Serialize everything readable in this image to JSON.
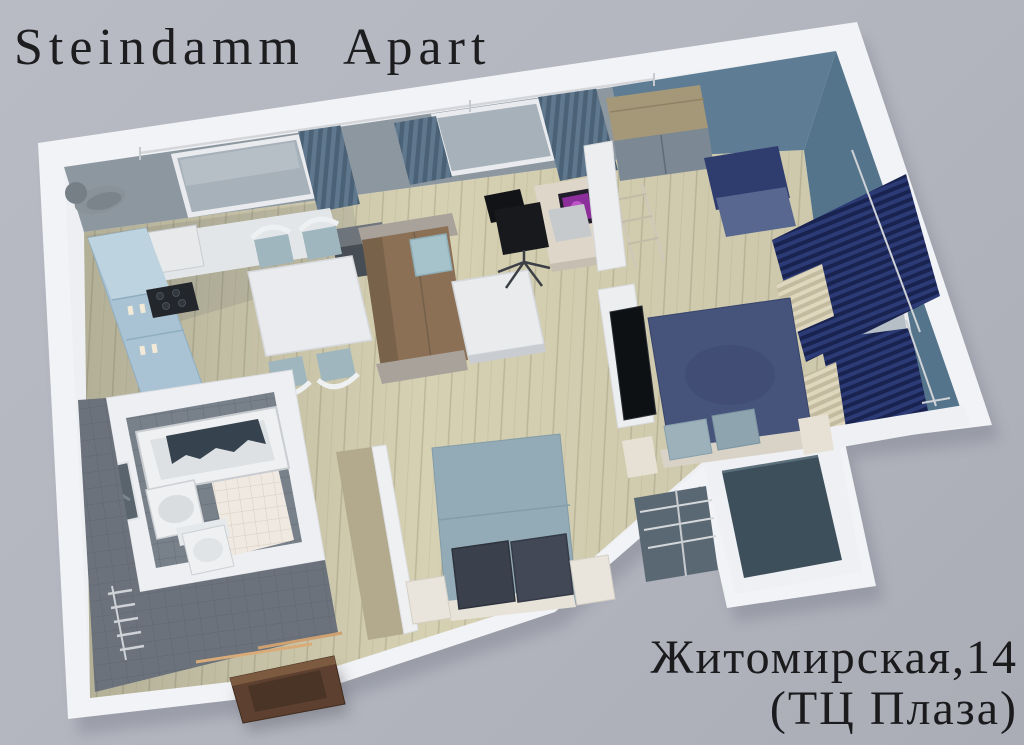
{
  "scene": {
    "kind": "3d-apartment-floorplan-render",
    "title": "Steindamm Apart",
    "address_line1": "Житомирская,14",
    "address_line2": "(ТЦ Плаза)"
  },
  "palette": {
    "background": "#b2b4be",
    "outer_wall_white": "#f2f3f6",
    "inner_wall_gray": "#8d97a0",
    "bedroom_wall_blue": "#5e7d95",
    "floor_wood": "#d7d1b3",
    "floor_tile_dark": "#6b727c",
    "floor_balcony": "#3e4f5c",
    "curtain_navy": "#24306b",
    "curtain_slate": "#5d7489",
    "sofa_brown": "#8b7056",
    "bed_navy": "#46537b",
    "bed_light_blue": "#93abb6",
    "kitchen_cabinet_blue": "#a9c3d4",
    "entrance_door_brown": "#5d4030",
    "text": "#1d1d20"
  },
  "rooms": [
    "kitchen",
    "dining-area",
    "living-room",
    "bedroom",
    "second-bedroom",
    "bathroom",
    "hallway",
    "balcony"
  ],
  "furniture": [
    "kitchen-cabinets",
    "fridge",
    "stove",
    "dining-table",
    "dining-chairs",
    "sofa",
    "sofa-pillow",
    "coffee-table",
    "desk",
    "laptop",
    "office-chair",
    "shelf-ladder",
    "wardrobe",
    "armchair",
    "navy-double-bed",
    "tv",
    "radiators",
    "window-curtains",
    "light-blue-double-bed",
    "nightstands",
    "balcony-railing",
    "bathtub",
    "shower-curtain",
    "wash-basin",
    "toilet",
    "mirror",
    "towel-radiator",
    "entrance-door",
    "vent-pipe"
  ]
}
